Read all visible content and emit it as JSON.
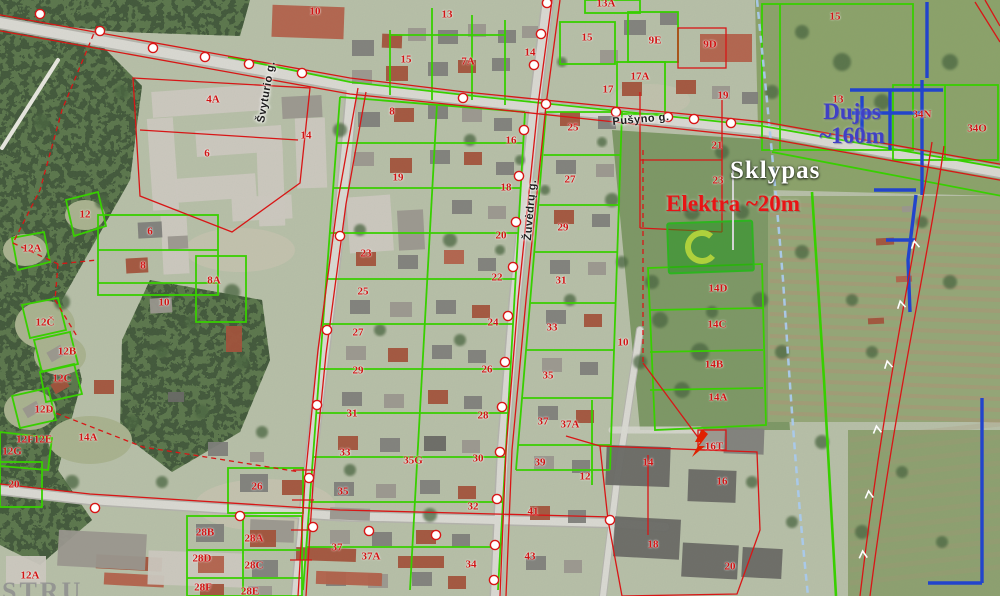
{
  "map": {
    "callouts": {
      "plot": "Sklypas",
      "electricity": "Elektra ~20m",
      "gas_line1": "Dujos",
      "gas_line2": "~160m"
    },
    "streets": [
      {
        "name": "Pušyno g.",
        "x": 641,
        "y": 120,
        "rot": -5
      },
      {
        "name": "Žuvėdrų g.",
        "x": 531,
        "y": 210,
        "rot": -85
      },
      {
        "name": "Švyturio g.",
        "x": 267,
        "y": 92,
        "rot": -80
      }
    ],
    "watermark": "STRU",
    "transformer_label": "16T",
    "parcel_labels": [
      {
        "t": "10",
        "x": 315,
        "y": 12
      },
      {
        "t": "4A",
        "x": 213,
        "y": 100
      },
      {
        "t": "14",
        "x": 306,
        "y": 136
      },
      {
        "t": "6",
        "x": 207,
        "y": 154
      },
      {
        "t": "12",
        "x": 85,
        "y": 215
      },
      {
        "t": "12A",
        "x": 32,
        "y": 249
      },
      {
        "t": "6",
        "x": 150,
        "y": 232
      },
      {
        "t": "8",
        "x": 143,
        "y": 266
      },
      {
        "t": "8A",
        "x": 214,
        "y": 281
      },
      {
        "t": "10",
        "x": 164,
        "y": 303
      },
      {
        "t": "12Č",
        "x": 45,
        "y": 323
      },
      {
        "t": "12B",
        "x": 67,
        "y": 352
      },
      {
        "t": "12C",
        "x": 62,
        "y": 379
      },
      {
        "t": "12D",
        "x": 44,
        "y": 410
      },
      {
        "t": "12F",
        "x": 25,
        "y": 440
      },
      {
        "t": "12E",
        "x": 43,
        "y": 440
      },
      {
        "t": "12G",
        "x": 12,
        "y": 452
      },
      {
        "t": "14A",
        "x": 88,
        "y": 438
      },
      {
        "t": "20",
        "x": 14,
        "y": 485
      },
      {
        "t": "12A",
        "x": 30,
        "y": 576
      },
      {
        "t": "15",
        "x": 406,
        "y": 60
      },
      {
        "t": "13",
        "x": 447,
        "y": 15
      },
      {
        "t": "7A",
        "x": 468,
        "y": 62
      },
      {
        "t": "14",
        "x": 530,
        "y": 53
      },
      {
        "t": "8",
        "x": 392,
        "y": 112
      },
      {
        "t": "19",
        "x": 398,
        "y": 178
      },
      {
        "t": "23",
        "x": 366,
        "y": 254
      },
      {
        "t": "25",
        "x": 363,
        "y": 292
      },
      {
        "t": "27",
        "x": 358,
        "y": 333
      },
      {
        "t": "29",
        "x": 358,
        "y": 371
      },
      {
        "t": "31",
        "x": 352,
        "y": 414
      },
      {
        "t": "33",
        "x": 345,
        "y": 453
      },
      {
        "t": "35",
        "x": 343,
        "y": 492
      },
      {
        "t": "37",
        "x": 337,
        "y": 548
      },
      {
        "t": "37A",
        "x": 371,
        "y": 557
      },
      {
        "t": "35G",
        "x": 413,
        "y": 461
      },
      {
        "t": "16",
        "x": 511,
        "y": 141
      },
      {
        "t": "18",
        "x": 506,
        "y": 188
      },
      {
        "t": "20",
        "x": 501,
        "y": 236
      },
      {
        "t": "22",
        "x": 497,
        "y": 278
      },
      {
        "t": "24",
        "x": 493,
        "y": 323
      },
      {
        "t": "26",
        "x": 487,
        "y": 370
      },
      {
        "t": "28",
        "x": 483,
        "y": 416
      },
      {
        "t": "30",
        "x": 478,
        "y": 459
      },
      {
        "t": "32",
        "x": 473,
        "y": 507
      },
      {
        "t": "34",
        "x": 471,
        "y": 565
      },
      {
        "t": "25",
        "x": 573,
        "y": 128
      },
      {
        "t": "27",
        "x": 570,
        "y": 180
      },
      {
        "t": "29",
        "x": 563,
        "y": 228
      },
      {
        "t": "31",
        "x": 561,
        "y": 281
      },
      {
        "t": "33",
        "x": 552,
        "y": 328
      },
      {
        "t": "35",
        "x": 548,
        "y": 376
      },
      {
        "t": "37",
        "x": 543,
        "y": 422
      },
      {
        "t": "37A",
        "x": 570,
        "y": 425
      },
      {
        "t": "39",
        "x": 540,
        "y": 463
      },
      {
        "t": "41",
        "x": 533,
        "y": 512
      },
      {
        "t": "43",
        "x": 530,
        "y": 557
      },
      {
        "t": "12",
        "x": 585,
        "y": 477
      },
      {
        "t": "10",
        "x": 623,
        "y": 343
      },
      {
        "t": "13A",
        "x": 606,
        "y": 4
      },
      {
        "t": "15",
        "x": 587,
        "y": 38
      },
      {
        "t": "9E",
        "x": 655,
        "y": 41
      },
      {
        "t": "9D",
        "x": 710,
        "y": 45
      },
      {
        "t": "17A",
        "x": 640,
        "y": 77
      },
      {
        "t": "17",
        "x": 608,
        "y": 90
      },
      {
        "t": "19",
        "x": 723,
        "y": 96
      },
      {
        "t": "21",
        "x": 717,
        "y": 146
      },
      {
        "t": "23",
        "x": 718,
        "y": 181
      },
      {
        "t": "15",
        "x": 835,
        "y": 17
      },
      {
        "t": "13",
        "x": 838,
        "y": 100
      },
      {
        "t": "34N",
        "x": 922,
        "y": 115
      },
      {
        "t": "34O",
        "x": 977,
        "y": 129
      },
      {
        "t": "14D",
        "x": 718,
        "y": 289
      },
      {
        "t": "14C",
        "x": 717,
        "y": 325
      },
      {
        "t": "14B",
        "x": 714,
        "y": 365
      },
      {
        "t": "14A",
        "x": 718,
        "y": 398
      },
      {
        "t": "16T",
        "x": 714,
        "y": 447
      },
      {
        "t": "14",
        "x": 648,
        "y": 463
      },
      {
        "t": "16",
        "x": 722,
        "y": 482
      },
      {
        "t": "18",
        "x": 653,
        "y": 545
      },
      {
        "t": "20",
        "x": 730,
        "y": 567
      },
      {
        "t": "26",
        "x": 257,
        "y": 487
      },
      {
        "t": "28B",
        "x": 205,
        "y": 533
      },
      {
        "t": "28A",
        "x": 254,
        "y": 539
      },
      {
        "t": "28D",
        "x": 202,
        "y": 559
      },
      {
        "t": "28C",
        "x": 254,
        "y": 566
      },
      {
        "t": "28F",
        "x": 203,
        "y": 588
      },
      {
        "t": "28E",
        "x": 250,
        "y": 592
      }
    ],
    "colors": {
      "parcel_boundary": "#38cf00",
      "cadastral_line": "#d81616",
      "gas_pipeline": "#2244cc",
      "stream": "#a9c9ec",
      "highlight_fill": "#1e9619",
      "highlight_stroke": "#2db420",
      "callout_plot": "#ffffff",
      "callout_electricity": "#e81414",
      "callout_gas": "#4040c6"
    }
  }
}
